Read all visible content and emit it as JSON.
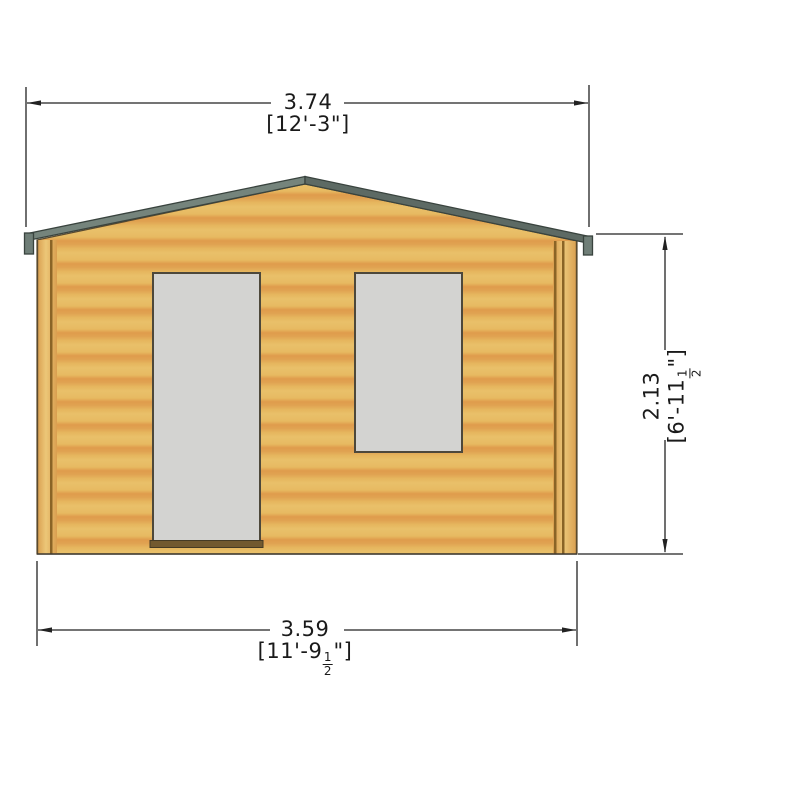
{
  "drawing": {
    "title": "log-cabin-front-elevation",
    "dimensions": {
      "top": {
        "metric": "3.74",
        "imperial": "[12'-3\"]"
      },
      "bottom": {
        "metric": "3.59",
        "imperial_prefix": "[11'-9",
        "fraction_numerator": "1",
        "fraction_denominator": "2",
        "imperial_suffix": "\"]"
      },
      "right": {
        "metric": "2.13",
        "imperial_prefix": "[6'-11",
        "fraction_numerator": "1",
        "fraction_denominator": "2",
        "imperial_suffix": "\"]"
      }
    },
    "colors": {
      "wood_light": "#e9c06a",
      "wood_dark": "#df9b4b",
      "post_light": "#ecc778",
      "post_dark": "#d99e4f",
      "grain_line": "#8a6426",
      "wall_outline": "#5a4a2e",
      "roof_left": "#75847c",
      "roof_right": "#5d6a64",
      "roof_cap": "#6f7e77",
      "roof_outline": "#39433e",
      "glass": "#d3d3d1",
      "frame_outline": "#4d483b",
      "sill": "#72592f",
      "dimension_line": "#222222"
    }
  }
}
